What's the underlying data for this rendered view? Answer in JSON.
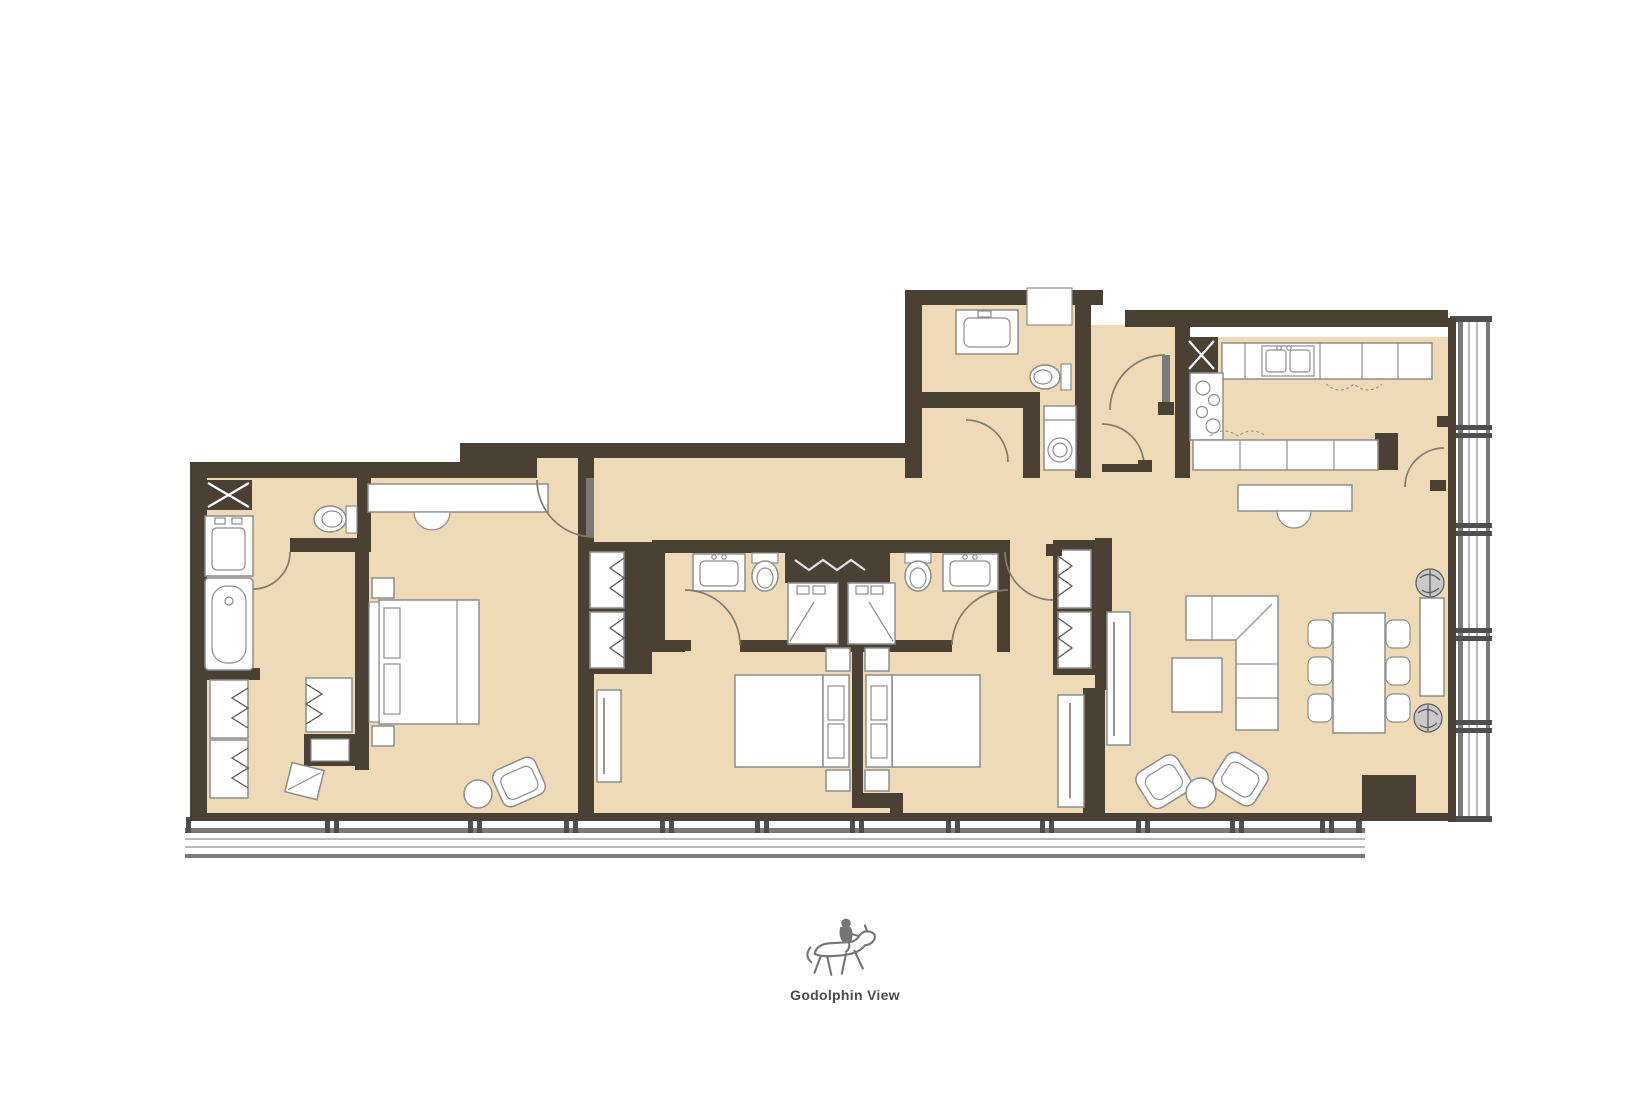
{
  "logo": {
    "caption": "Godolphin View",
    "icon": "horse-rider-icon"
  },
  "palette": {
    "bg": "#ffffff",
    "wall": "#4a4134",
    "floor": "#eedab6",
    "line": "#8e8e8e",
    "line_dark": "#5a5a5a",
    "door": "#847a6a",
    "glaze_dark": "#7a7a7a",
    "glaze_mid": "#b9b9b9",
    "mullion": "#4e4e4e",
    "caption": "#4b4b4b",
    "icon": "#757575"
  }
}
